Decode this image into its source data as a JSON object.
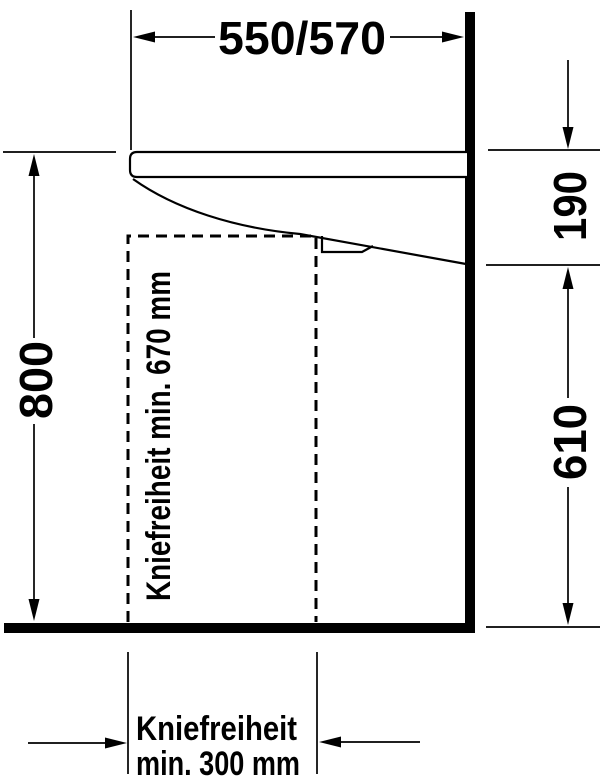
{
  "colors": {
    "ink": "#000000",
    "paper": "#ffffff"
  },
  "labels": {
    "top_width": "550/570",
    "left_height": "800",
    "right_depth": "190",
    "right_height": "610",
    "knee_depth": "Kniefreiheit min. 670 mm",
    "knee_width_line1": "Kniefreiheit",
    "knee_width_line2": "min. 300 mm"
  }
}
